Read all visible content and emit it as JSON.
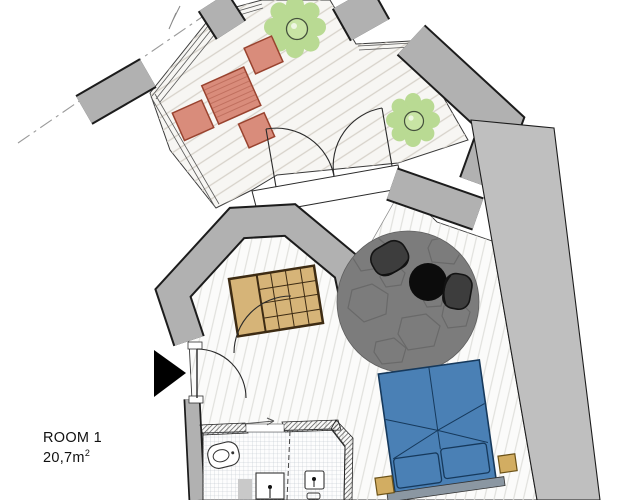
{
  "room_label": {
    "name": "ROOM 1",
    "area_value": "20,7m",
    "area_exponent": "2"
  },
  "colors": {
    "wall": "#b1b1b1",
    "wall_outline": "#1c1c1c",
    "right_wall": "#bfbfbf",
    "deck_floor": "#f7f6f3",
    "deck_line": "#d7d2ca",
    "room_floor": "#fbfbfa",
    "floor_line": "#dededa",
    "plant": "#b9da93",
    "plant_ring": "#44503c",
    "terrace_set": "#d98c7b",
    "terrace_set_border": "#99432f",
    "wardrobe": "#d6b478",
    "wardrobe_border": "#3d2b13",
    "rug": "#7c7c7c",
    "rug_pattern": "#696969",
    "armchair": "#3d3d3d",
    "side_table": "#0c0c0c",
    "bed": "#4a80b5",
    "bed_line": "#16395c",
    "headboard": "#8b97a2",
    "nightstand": "#d2ad62",
    "nightstand_border": "#6b5218",
    "door_arc": "#2a2a2a",
    "tile_line": "#b7c0c7",
    "entrance_arrow": "#000000",
    "property_line": "#9a9a9a",
    "label": "#111111"
  },
  "icons": {
    "entrance-arrow-icon": "▶",
    "plant-icon": "round plant canopy",
    "toilet-icon": "toilet top view",
    "sink-icon": "washbasin with tap",
    "double-door-icon": "french door swing arcs",
    "door-icon": "door swing arc"
  }
}
